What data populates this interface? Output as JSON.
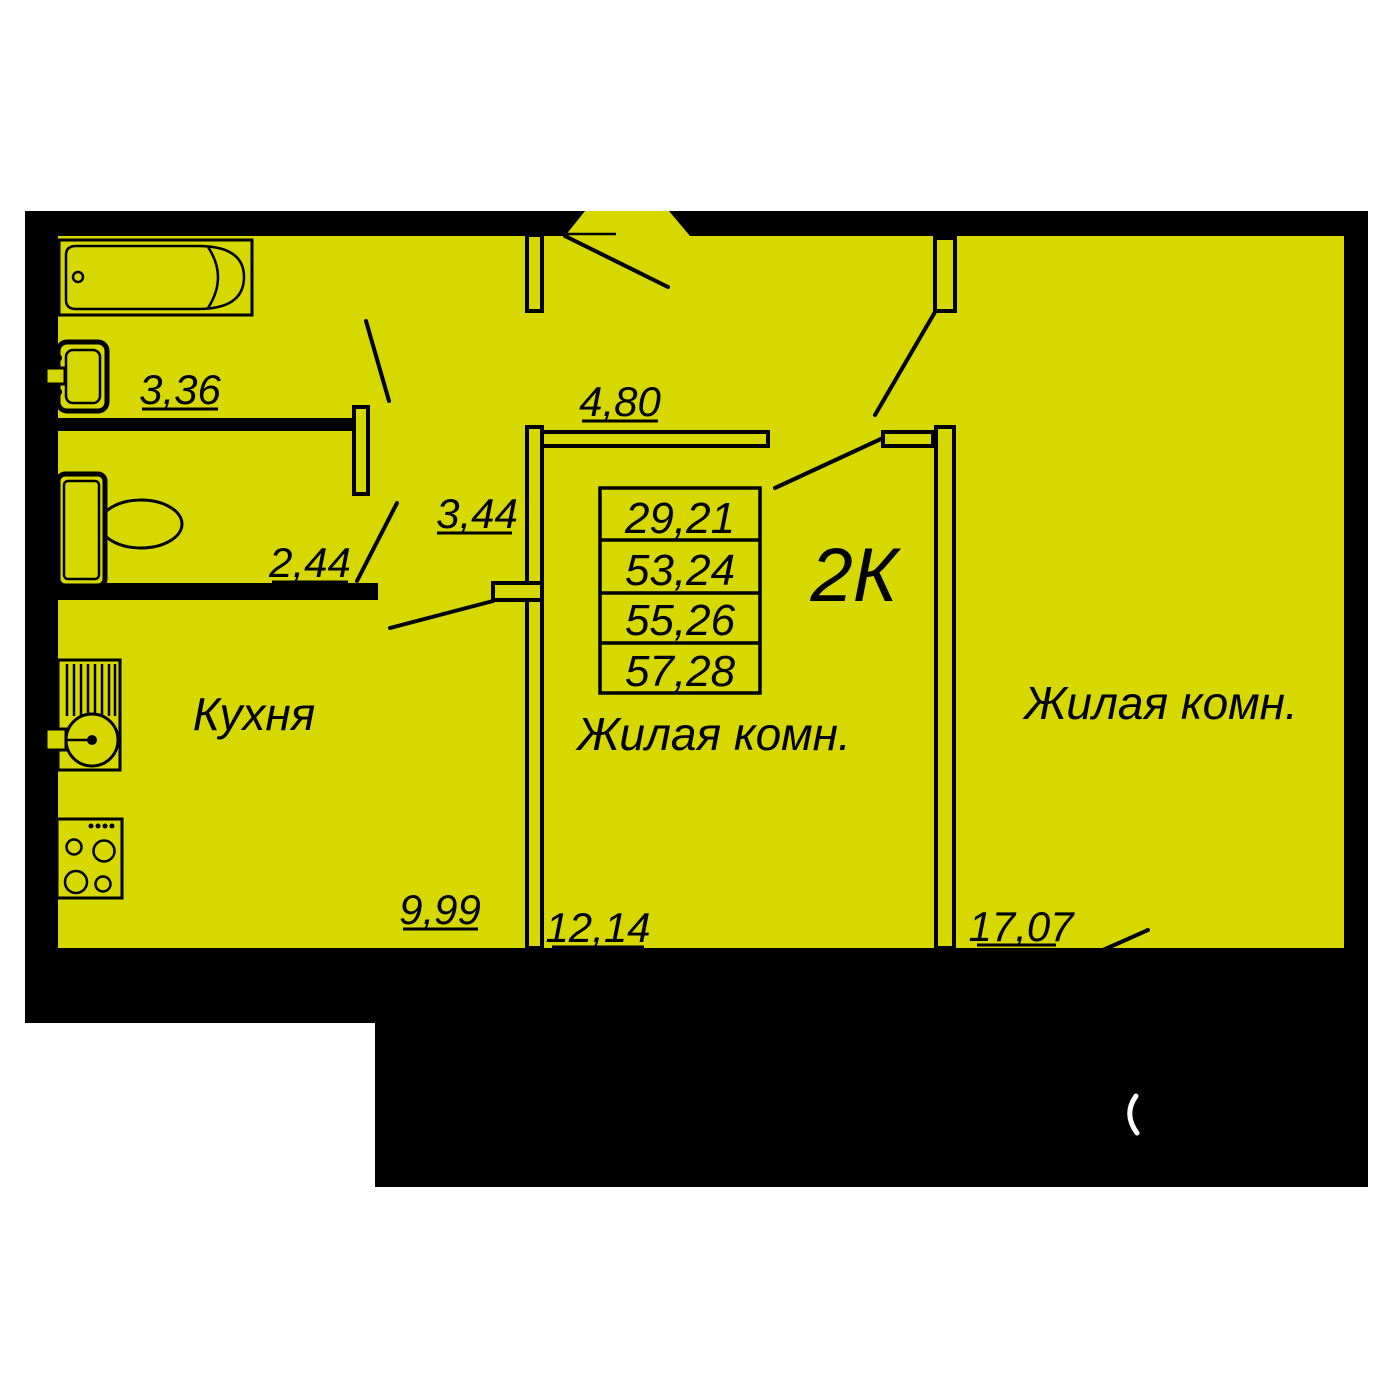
{
  "unit": {
    "type_label": "2К"
  },
  "area_table": {
    "values": [
      "29,21",
      "53,24",
      "55,26",
      "57,28"
    ]
  },
  "labels": {
    "kitchen": {
      "name": "Кухня",
      "area": "9,99"
    },
    "living_middle": {
      "name": "Жилая комн.",
      "area": "12,14"
    },
    "living_right": {
      "name": "Жилая комн.",
      "area": "17,07"
    },
    "bathroom": {
      "area": "3,36"
    },
    "toilet": {
      "area": "2,44"
    },
    "hall": {
      "area": "3,44"
    },
    "hall_top": {
      "area": "4,80"
    }
  },
  "colors": {
    "floor": "#d6d800",
    "wall": "#000000",
    "background": "#ffffff",
    "text": "#000000",
    "arc": "#ffffff"
  }
}
